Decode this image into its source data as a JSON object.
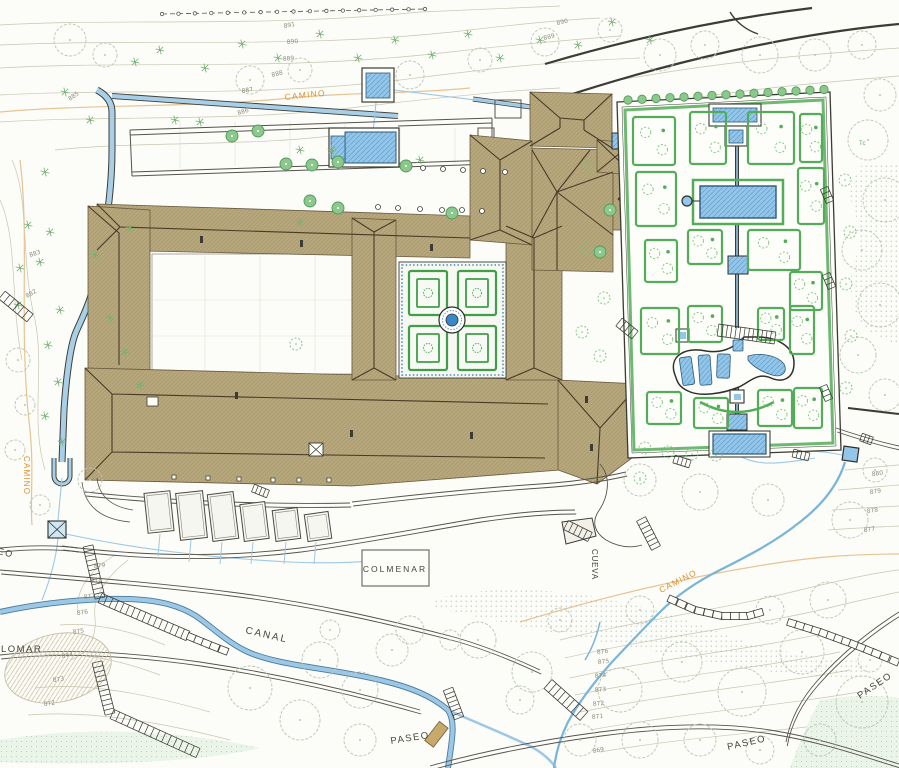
{
  "map": {
    "place_labels": [
      {
        "id": "camino-top",
        "text": "CAMINO",
        "x": 285,
        "y": 100,
        "rot": -6,
        "size": 8.5,
        "color": "orange",
        "spacing": 1.2
      },
      {
        "id": "camino-left",
        "text": "CAMINO",
        "x": 24,
        "y": 456,
        "rot": 90,
        "size": 8,
        "color": "orange",
        "spacing": 1.2
      },
      {
        "id": "camino-southeast",
        "text": "CAMINO",
        "x": 661,
        "y": 593,
        "rot": -27,
        "size": 8.5,
        "color": "orange",
        "spacing": 1.2
      },
      {
        "id": "canal-label",
        "text": "CANAL",
        "x": 245,
        "y": 633,
        "rot": 13,
        "size": 10,
        "color": "dark",
        "spacing": 2
      },
      {
        "id": "colmenar-label",
        "text": "COLMENAR",
        "x": 395,
        "y": 572,
        "rot": 0,
        "size": 8.5,
        "color": "dark",
        "spacing": 2,
        "anchor": "middle"
      },
      {
        "id": "palomar-label",
        "text": "PALOMAR",
        "x": -14,
        "y": 652,
        "rot": 0,
        "size": 9.5,
        "color": "dark",
        "spacing": 1.5
      },
      {
        "id": "cueva-label",
        "text": "CUEVA",
        "x": 592,
        "y": 549,
        "rot": 90,
        "size": 8,
        "color": "dark",
        "spacing": 0.8
      },
      {
        "id": "paseo-left",
        "text": "PASEO",
        "x": -24,
        "y": 549,
        "rot": 13,
        "size": 9,
        "color": "dark",
        "spacing": 1.5
      },
      {
        "id": "paseo-center",
        "text": "PASEO",
        "x": 391,
        "y": 744,
        "rot": -9,
        "size": 9.5,
        "color": "dark",
        "spacing": 1.5
      },
      {
        "id": "paseo-south",
        "text": "PASEO",
        "x": 728,
        "y": 750,
        "rot": -13,
        "size": 9.5,
        "color": "dark",
        "spacing": 1.5
      },
      {
        "id": "paseo-east",
        "text": "PASEO",
        "x": 860,
        "y": 699,
        "rot": -34,
        "size": 9.5,
        "color": "dark",
        "spacing": 1.5
      },
      {
        "id": "tree-note",
        "text": "Tc",
        "x": 859,
        "y": 145,
        "rot": 0,
        "size": 6,
        "color": "green",
        "spacing": 0.5
      }
    ],
    "elevation_labels": [
      {
        "t": "891",
        "x": 284,
        "y": 28,
        "r": -10
      },
      {
        "t": "890",
        "x": 287,
        "y": 44,
        "r": -6
      },
      {
        "t": "889",
        "x": 283,
        "y": 61,
        "r": -6
      },
      {
        "t": "888",
        "x": 272,
        "y": 77,
        "r": -14
      },
      {
        "t": "887",
        "x": 242,
        "y": 93,
        "r": -10
      },
      {
        "t": "886",
        "x": 238,
        "y": 115,
        "r": -16
      },
      {
        "t": "885",
        "x": 70,
        "y": 101,
        "r": -35
      },
      {
        "t": "890",
        "x": 557,
        "y": 25,
        "r": -12
      },
      {
        "t": "889",
        "x": 544,
        "y": 40,
        "r": -14
      },
      {
        "t": "883",
        "x": 30,
        "y": 257,
        "r": -18
      },
      {
        "t": "882",
        "x": 27,
        "y": 298,
        "r": -30
      },
      {
        "t": "880",
        "x": 872,
        "y": 476,
        "r": -8
      },
      {
        "t": "879",
        "x": 870,
        "y": 494,
        "r": -8
      },
      {
        "t": "878",
        "x": 867,
        "y": 513,
        "r": -8
      },
      {
        "t": "877",
        "x": 864,
        "y": 532,
        "r": -8
      },
      {
        "t": "879",
        "x": 94,
        "y": 568,
        "r": -6
      },
      {
        "t": "878",
        "x": 91,
        "y": 583,
        "r": -8
      },
      {
        "t": "877",
        "x": 84,
        "y": 599,
        "r": -8
      },
      {
        "t": "876",
        "x": 77,
        "y": 615,
        "r": -8
      },
      {
        "t": "875",
        "x": 73,
        "y": 634,
        "r": -8
      },
      {
        "t": "874",
        "x": 62,
        "y": 658,
        "r": -8
      },
      {
        "t": "873",
        "x": 53,
        "y": 682,
        "r": -8
      },
      {
        "t": "872",
        "x": 44,
        "y": 706,
        "r": -8
      },
      {
        "t": "876",
        "x": 597,
        "y": 654,
        "r": -6
      },
      {
        "t": "875",
        "x": 598,
        "y": 664,
        "r": -6
      },
      {
        "t": "874",
        "x": 595,
        "y": 678,
        "r": -6
      },
      {
        "t": "873",
        "x": 595,
        "y": 692,
        "r": -6
      },
      {
        "t": "872",
        "x": 593,
        "y": 706,
        "r": -6
      },
      {
        "t": "871",
        "x": 592,
        "y": 719,
        "r": -6
      },
      {
        "t": "869",
        "x": 593,
        "y": 753,
        "r": -10
      }
    ],
    "colors": {
      "orange": "#dd8f2e",
      "dark": "#45453c",
      "green": "#6aa86a",
      "elevation": "#8f8c7a",
      "water_fill": "#a8cfe8",
      "pool_fill": "#93c6e8",
      "hedge_green": "#53ad58",
      "roof_tan": "#b6a77c",
      "ridge_brown": "#4a3b28",
      "contour": "#c9c6ae",
      "road": "#55534a"
    }
  }
}
